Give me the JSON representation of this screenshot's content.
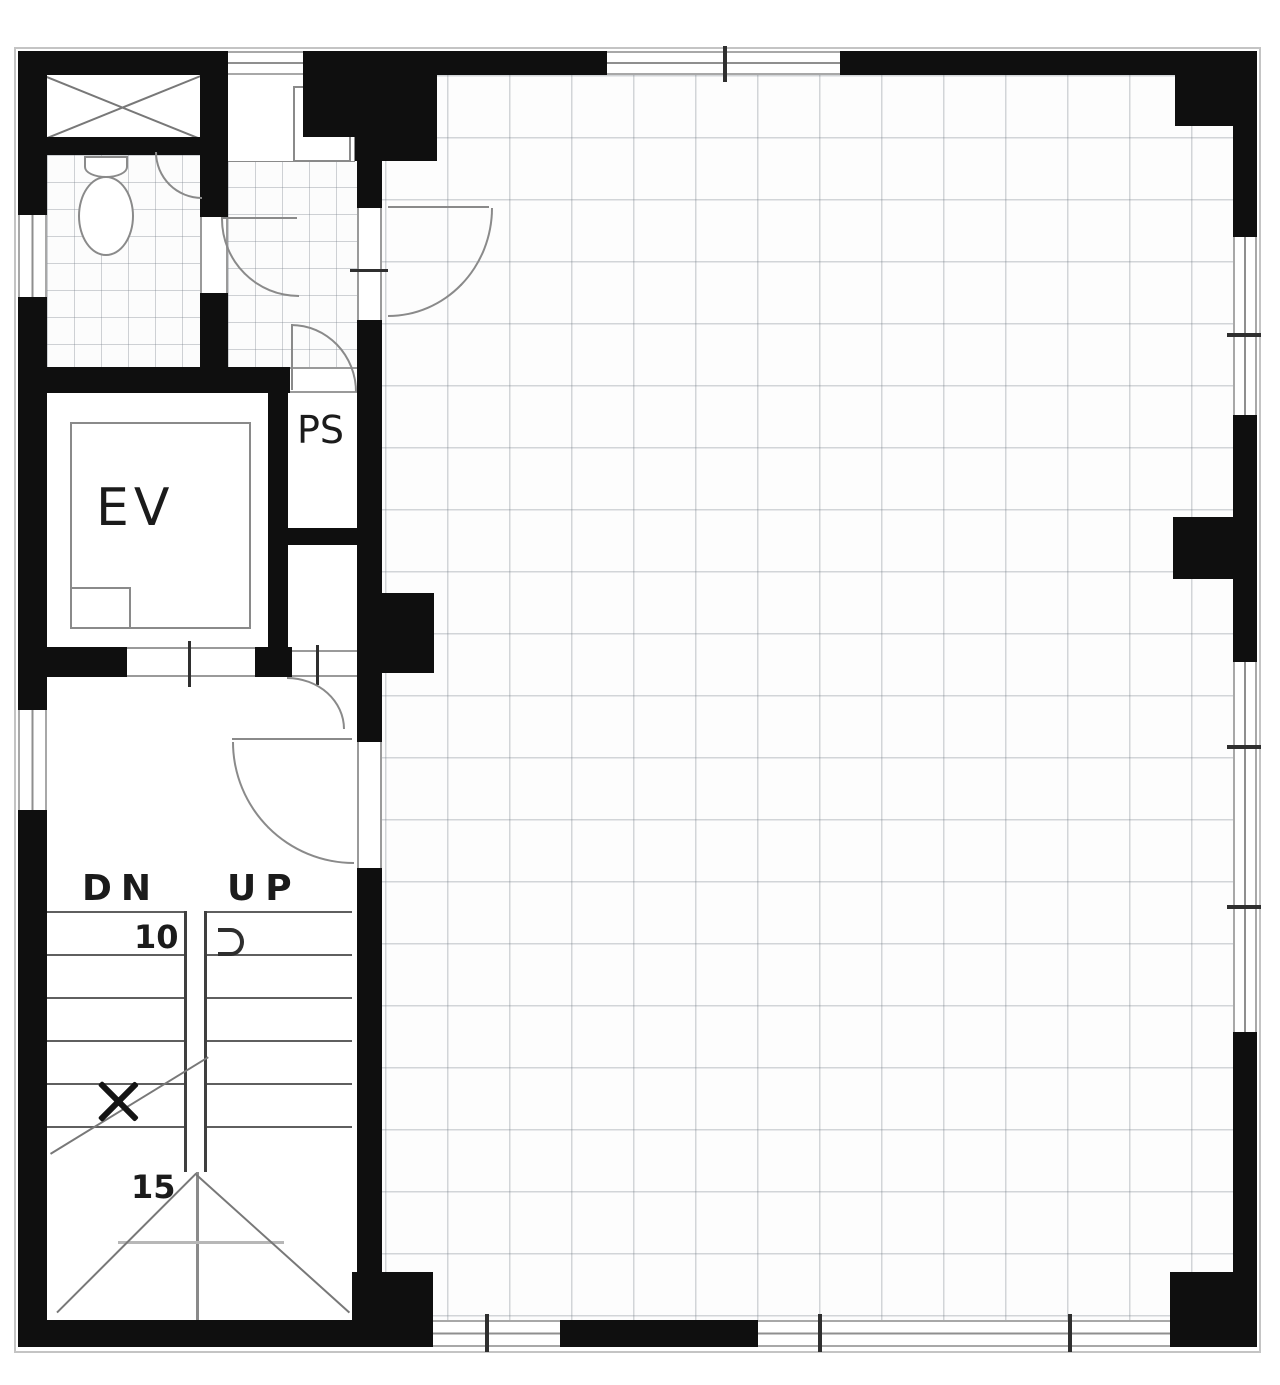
{
  "labels": {
    "elevator": "EV",
    "pipe_shaft": "PS",
    "stair_down": "DN",
    "stair_up": "UP",
    "step_number_top": "10",
    "step_number_bottom": "15"
  },
  "colors": {
    "wall": "#0f0f0f",
    "detail_line": "#8a8a8a",
    "grid_line": "#c9ced2",
    "text": "#1b1b1b"
  }
}
